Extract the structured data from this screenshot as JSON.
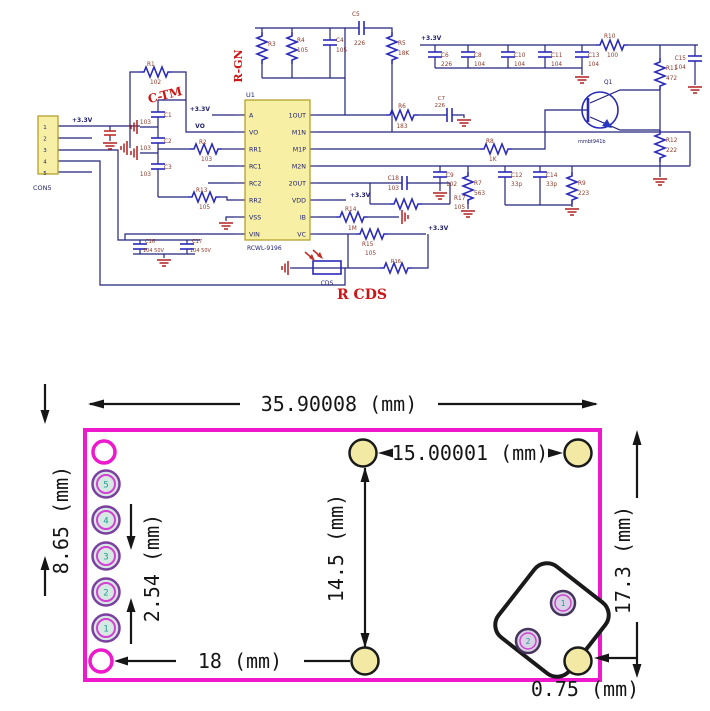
{
  "schematic": {
    "connector": {
      "ref": "CON5",
      "pins": [
        "1",
        "2",
        "3",
        "4",
        "5"
      ]
    },
    "ic": {
      "ref": "U1",
      "part": "RCWL-9196",
      "left_pins": [
        "A",
        "VO",
        "RR1",
        "RC1",
        "RC2",
        "RR2",
        "VSS",
        "VIN"
      ],
      "right_pins": [
        "1OUT",
        "M1N",
        "M1P",
        "M2N",
        "2OUT",
        "VDD",
        "IB",
        "VC"
      ]
    },
    "net_labels": {
      "v33": "+3.3V",
      "vo": "VO"
    },
    "red_labels": {
      "rgn": "R-GN",
      "ctm": "C-TM",
      "rcds": "R CDS"
    },
    "components": {
      "r1": {
        "ref": "R1",
        "val": "102"
      },
      "r2": {
        "ref": "R2",
        "val": "103"
      },
      "r3": {
        "ref": "R3",
        "val": ""
      },
      "r4": {
        "ref": "R4",
        "val": "105"
      },
      "r5": {
        "ref": "R5",
        "val": "18K"
      },
      "r6": {
        "ref": "R6",
        "val": "183"
      },
      "r7": {
        "ref": "R7",
        "val": "563"
      },
      "r8": {
        "ref": "R8",
        "val": "1K"
      },
      "r9": {
        "ref": "R9",
        "val": "223"
      },
      "r10": {
        "ref": "R10",
        "val": "100"
      },
      "r11": {
        "ref": "R11",
        "val": "472"
      },
      "r12": {
        "ref": "R12",
        "val": "222"
      },
      "r13": {
        "ref": "R13",
        "val": "105"
      },
      "r14": {
        "ref": "R14",
        "val": "1M"
      },
      "r15": {
        "ref": "R15",
        "val": "105"
      },
      "r16": {
        "ref": "R16",
        "val": ""
      },
      "r17": {
        "ref": "R17",
        "val": "105"
      },
      "c1": {
        "ref": "C1",
        "val": "103"
      },
      "c2": {
        "ref": "C2",
        "val": "103"
      },
      "c3": {
        "ref": "C3",
        "val": "103"
      },
      "c4": {
        "ref": "C4",
        "val": "105"
      },
      "c5": {
        "ref": "C5",
        "val": "226"
      },
      "c6": {
        "ref": "C6",
        "val": "226"
      },
      "c7": {
        "ref": "C7",
        "val": "226"
      },
      "c8": {
        "ref": "C8",
        "val": "104"
      },
      "c9": {
        "ref": "C9",
        "val": "102"
      },
      "c10": {
        "ref": "C10",
        "val": "104"
      },
      "c11": {
        "ref": "C11",
        "val": "104"
      },
      "c12": {
        "ref": "C12",
        "val": "33p"
      },
      "c13": {
        "ref": "C13",
        "val": "104"
      },
      "c14": {
        "ref": "C14",
        "val": "33p"
      },
      "c15": {
        "ref": "C15",
        "val": "104"
      },
      "c16": {
        "ref": "C16",
        "val": "104 50V"
      },
      "c17": {
        "ref": "C17",
        "val": "104 50V"
      },
      "c18": {
        "ref": "C18",
        "val": "103"
      },
      "q1": {
        "ref": "Q1",
        "val": "mmbt941b"
      },
      "cds": {
        "ref": "CDS",
        "val": ""
      }
    }
  },
  "board": {
    "dims": {
      "width": "35.90008 (mm)",
      "hole_span": "15.00001 (mm)",
      "left_edge": "8.65 (mm)",
      "pin_pitch": "2.54 (mm)",
      "hole_vertical": "14.5 (mm)",
      "right_edge": "17.3 (mm)",
      "bottom_span": "18 (mm)",
      "corner_offset": "0.75 (mm)"
    },
    "pads_left": [
      "5",
      "4",
      "3",
      "2",
      "1"
    ],
    "sensor_pads": [
      "1",
      "2"
    ],
    "colors": {
      "outline": "#ee18cc",
      "hole_fill": "#f2e9a4",
      "pad_fill": "#d5e9e2",
      "sensor_pad_fill": "#d9d2e6",
      "accent_red": "#cc1515"
    }
  }
}
